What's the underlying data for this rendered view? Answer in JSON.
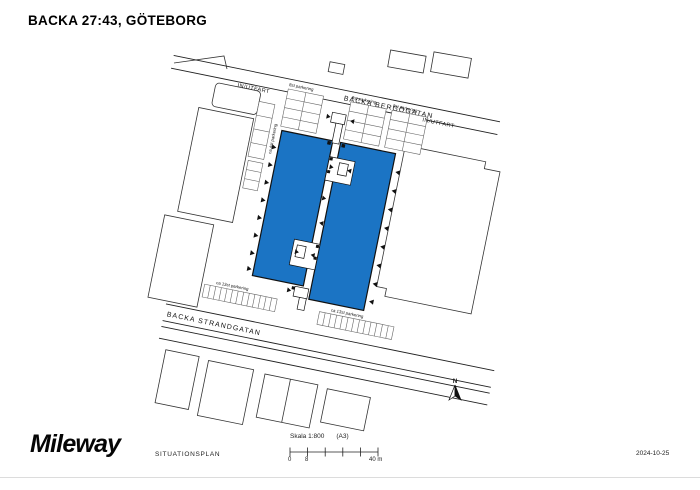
{
  "title": "BACKA 27:43, GÖTEBORG",
  "plan": {
    "streets": {
      "top": "BACKA BERGÖGATAN",
      "bottom": "BACKA STRANDGATAN"
    },
    "entries": {
      "left": "IN/UTFART",
      "right": "IN/UTFART"
    },
    "parking": {
      "top": [
        "8st parkering",
        "8st parkering",
        "8st parkering"
      ],
      "west": "ca 4st parkering",
      "south": [
        "ca 13st parkering",
        "ca 13st parkering"
      ]
    },
    "north_label": "N",
    "colors": {
      "building_fill": "#1B74C4",
      "outline": "#111111"
    }
  },
  "footer": {
    "logo": "Mileway",
    "drawing_type": "SITUATIONSPLAN",
    "scale": {
      "label": "Skala 1:800",
      "paper": "(A3)",
      "ticks": [
        "0",
        "8",
        "40 m"
      ]
    },
    "date": "2024-10-25"
  }
}
